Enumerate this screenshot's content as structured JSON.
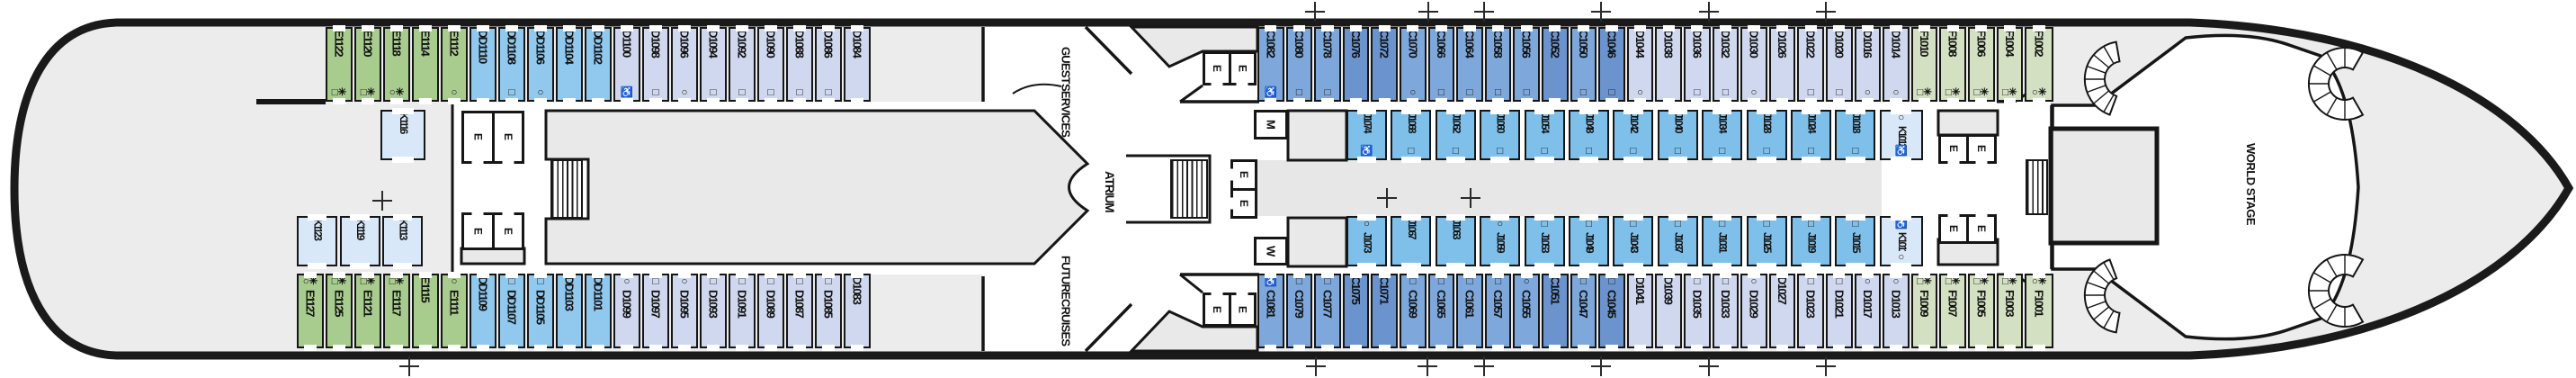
{
  "deck": {
    "venues": {
      "guest_services": [
        "GUEST",
        "SERVICES"
      ],
      "future_cruises": [
        "FUTURE",
        "CRUISES"
      ],
      "atrium": "ATRIUM",
      "world_stage": "WORLD STAGE"
    },
    "rooms": {
      "elevator": "E",
      "mens": "M",
      "womens": "W"
    },
    "cabin_colors": {
      "e": "#a8cb8e",
      "f": "#d4e0c2",
      "dd": "#90c8ee",
      "j": "#7fc0ea",
      "d": "#cfd8ee",
      "c": "#7ea8db",
      "c2": "#6b94ce",
      "k": "#d8e8f8"
    }
  },
  "rows": {
    "tol": [
      {
        "n": "E1122",
        "c": "e",
        "s": "□✳"
      },
      {
        "n": "E1120",
        "c": "e",
        "s": "□✳"
      },
      {
        "n": "E1118",
        "c": "e",
        "s": "○✳"
      },
      {
        "n": "E1114",
        "c": "e",
        "s": ""
      },
      {
        "n": "E1112",
        "c": "e",
        "s": "○"
      },
      {
        "n": "DD1110",
        "c": "dd",
        "s": ""
      },
      {
        "n": "DD1108",
        "c": "dd",
        "s": "□"
      },
      {
        "n": "DD1106",
        "c": "dd",
        "s": "○"
      },
      {
        "n": "DD1104",
        "c": "dd",
        "s": ""
      },
      {
        "n": "DD1102",
        "c": "dd",
        "s": ""
      },
      {
        "n": "D1100",
        "c": "d",
        "s": "♿"
      },
      {
        "n": "D1098",
        "c": "d",
        "s": "□"
      },
      {
        "n": "D1096",
        "c": "d",
        "s": "○"
      },
      {
        "n": "D1094",
        "c": "d",
        "s": "□"
      },
      {
        "n": "D1092",
        "c": "d",
        "s": "□"
      },
      {
        "n": "D1090",
        "c": "d",
        "s": "□"
      },
      {
        "n": "D1088",
        "c": "d",
        "s": "□"
      },
      {
        "n": "D1086",
        "c": "d",
        "s": "□"
      },
      {
        "n": "D1084",
        "c": "d",
        "s": ""
      }
    ],
    "bol": [
      {
        "n": "E1127",
        "c": "e",
        "s": "○✳"
      },
      {
        "n": "E1125",
        "c": "e",
        "s": "□✳"
      },
      {
        "n": "E1121",
        "c": "e",
        "s": "□✳"
      },
      {
        "n": "E1117",
        "c": "e",
        "s": "□✳"
      },
      {
        "n": "E1115",
        "c": "e",
        "s": ""
      },
      {
        "n": "E1111",
        "c": "e",
        "s": "○"
      },
      {
        "n": "DD1109",
        "c": "dd",
        "s": ""
      },
      {
        "n": "DD1107",
        "c": "dd",
        "s": "□"
      },
      {
        "n": "DD1105",
        "c": "dd",
        "s": "□"
      },
      {
        "n": "DD1103",
        "c": "dd",
        "s": ""
      },
      {
        "n": "DD1101",
        "c": "dd",
        "s": ""
      },
      {
        "n": "D1099",
        "c": "d",
        "s": "○"
      },
      {
        "n": "D1097",
        "c": "d",
        "s": "□"
      },
      {
        "n": "D1095",
        "c": "d",
        "s": "○"
      },
      {
        "n": "D1093",
        "c": "d",
        "s": "□"
      },
      {
        "n": "D1091",
        "c": "d",
        "s": "□"
      },
      {
        "n": "D1089",
        "c": "d",
        "s": "□"
      },
      {
        "n": "D1087",
        "c": "d",
        "s": "□"
      },
      {
        "n": "D1085",
        "c": "d",
        "s": "□"
      },
      {
        "n": "D1083",
        "c": "d",
        "s": ""
      }
    ],
    "tor": [
      {
        "n": "C1082",
        "c": "c",
        "s": "♿"
      },
      {
        "n": "C1080",
        "c": "c",
        "s": "□"
      },
      {
        "n": "C1078",
        "c": "c",
        "s": "□"
      },
      {
        "n": "C1076",
        "c": "c2",
        "s": ""
      },
      {
        "n": "C1072",
        "c": "c2",
        "s": ""
      },
      {
        "n": "C1070",
        "c": "c",
        "s": "○"
      },
      {
        "n": "C1066",
        "c": "c",
        "s": "□"
      },
      {
        "n": "C1064",
        "c": "c",
        "s": "□"
      },
      {
        "n": "C1058",
        "c": "c",
        "s": "□"
      },
      {
        "n": "C1056",
        "c": "c",
        "s": "□"
      },
      {
        "n": "C1052",
        "c": "c2",
        "s": ""
      },
      {
        "n": "C1050",
        "c": "c",
        "s": "□"
      },
      {
        "n": "C1046",
        "c": "c2",
        "s": "□"
      },
      {
        "n": "D1044",
        "c": "d",
        "s": "○"
      },
      {
        "n": "D1038",
        "c": "d",
        "s": ""
      },
      {
        "n": "D1036",
        "c": "d",
        "s": "□"
      },
      {
        "n": "D1032",
        "c": "d",
        "s": "□"
      },
      {
        "n": "D1030",
        "c": "d",
        "s": "○"
      },
      {
        "n": "D1026",
        "c": "d",
        "s": ""
      },
      {
        "n": "D1022",
        "c": "d",
        "s": "□"
      },
      {
        "n": "D1020",
        "c": "d",
        "s": "□"
      },
      {
        "n": "D1016",
        "c": "d",
        "s": "○"
      },
      {
        "n": "D1014",
        "c": "d",
        "s": "○"
      },
      {
        "n": "F1010",
        "c": "f",
        "s": "□✳"
      },
      {
        "n": "F1008",
        "c": "f",
        "s": "□✳"
      },
      {
        "n": "F1006",
        "c": "f",
        "s": "□✳"
      },
      {
        "n": "F1004",
        "c": "f",
        "s": "□✳"
      },
      {
        "n": "F1002",
        "c": "f",
        "s": "○✳"
      }
    ],
    "bor": [
      {
        "n": "C1081",
        "c": "c",
        "s": "♿"
      },
      {
        "n": "C1079",
        "c": "c",
        "s": "□"
      },
      {
        "n": "C1077",
        "c": "c",
        "s": "□"
      },
      {
        "n": "C1075",
        "c": "c2",
        "s": ""
      },
      {
        "n": "C1071",
        "c": "c2",
        "s": ""
      },
      {
        "n": "C1069",
        "c": "c",
        "s": "□"
      },
      {
        "n": "C1065",
        "c": "c",
        "s": "□"
      },
      {
        "n": "C1061",
        "c": "c",
        "s": "□"
      },
      {
        "n": "C1057",
        "c": "c",
        "s": "□"
      },
      {
        "n": "C1055",
        "c": "c",
        "s": "○"
      },
      {
        "n": "C1051",
        "c": "c2",
        "s": ""
      },
      {
        "n": "C1047",
        "c": "c",
        "s": "□"
      },
      {
        "n": "C1045",
        "c": "c2",
        "s": "□"
      },
      {
        "n": "D1041",
        "c": "d",
        "s": ""
      },
      {
        "n": "D1039",
        "c": "d",
        "s": ""
      },
      {
        "n": "D1035",
        "c": "d",
        "s": "□"
      },
      {
        "n": "D1033",
        "c": "d",
        "s": "□"
      },
      {
        "n": "D1029",
        "c": "d",
        "s": "○"
      },
      {
        "n": "D1027",
        "c": "d",
        "s": ""
      },
      {
        "n": "D1023",
        "c": "d",
        "s": "□"
      },
      {
        "n": "D1021",
        "c": "d",
        "s": "□"
      },
      {
        "n": "D1017",
        "c": "d",
        "s": "○"
      },
      {
        "n": "D1013",
        "c": "d",
        "s": "○"
      },
      {
        "n": "F1009",
        "c": "f",
        "s": "□✳"
      },
      {
        "n": "F1007",
        "c": "f",
        "s": "□✳"
      },
      {
        "n": "F1005",
        "c": "f",
        "s": "□✳"
      },
      {
        "n": "F1003",
        "c": "f",
        "s": "□✳"
      },
      {
        "n": "F1001",
        "c": "f",
        "s": "○✳"
      }
    ],
    "tir": [
      {
        "n": "J1074",
        "c": "j",
        "s": "♿"
      },
      {
        "n": "J1068",
        "c": "j",
        "s": "□"
      },
      {
        "n": "J1062",
        "c": "j",
        "s": "□"
      },
      {
        "n": "J1060",
        "c": "j",
        "s": "□"
      },
      {
        "n": "J1054",
        "c": "j",
        "s": "□"
      },
      {
        "n": "J1048",
        "c": "j",
        "s": "□"
      },
      {
        "n": "J1042",
        "c": "j",
        "s": "□"
      },
      {
        "n": "J1040",
        "c": "j",
        "s": "□"
      },
      {
        "n": "J1034",
        "c": "j",
        "s": "□"
      },
      {
        "n": "J1028",
        "c": "j",
        "s": "□"
      },
      {
        "n": "J1024",
        "c": "j",
        "s": "□"
      },
      {
        "n": "J1018",
        "c": "j",
        "s": "□"
      },
      {
        "n": "K1012",
        "c": "k",
        "s": "♿",
        "s2": "○"
      }
    ],
    "bir": [
      {
        "n": "J1073",
        "c": "j",
        "s": "○"
      },
      {
        "n": "J1067",
        "c": "j",
        "s": ""
      },
      {
        "n": "J1063",
        "c": "j",
        "s": ""
      },
      {
        "n": "J1059",
        "c": "j",
        "s": "○"
      },
      {
        "n": "J1053",
        "c": "j",
        "s": "□"
      },
      {
        "n": "J1049",
        "c": "j",
        "s": "□"
      },
      {
        "n": "J1043",
        "c": "j",
        "s": "□"
      },
      {
        "n": "J1037",
        "c": "j",
        "s": "□"
      },
      {
        "n": "J1031",
        "c": "j",
        "s": "□"
      },
      {
        "n": "J1025",
        "c": "j",
        "s": "□"
      },
      {
        "n": "J1019",
        "c": "j",
        "s": "□"
      },
      {
        "n": "J1015",
        "c": "j",
        "s": "□"
      },
      {
        "n": "K1011",
        "c": "k",
        "s": "♿",
        "s2": "○"
      }
    ],
    "til": [
      {
        "n": "K1116",
        "c": "k",
        "s": ""
      }
    ],
    "bil": [
      {
        "n": "K1123",
        "c": "k",
        "s": ""
      },
      {
        "n": "K1119",
        "c": "k",
        "s": ""
      },
      {
        "n": "K1113",
        "c": "k",
        "s": ""
      }
    ]
  }
}
